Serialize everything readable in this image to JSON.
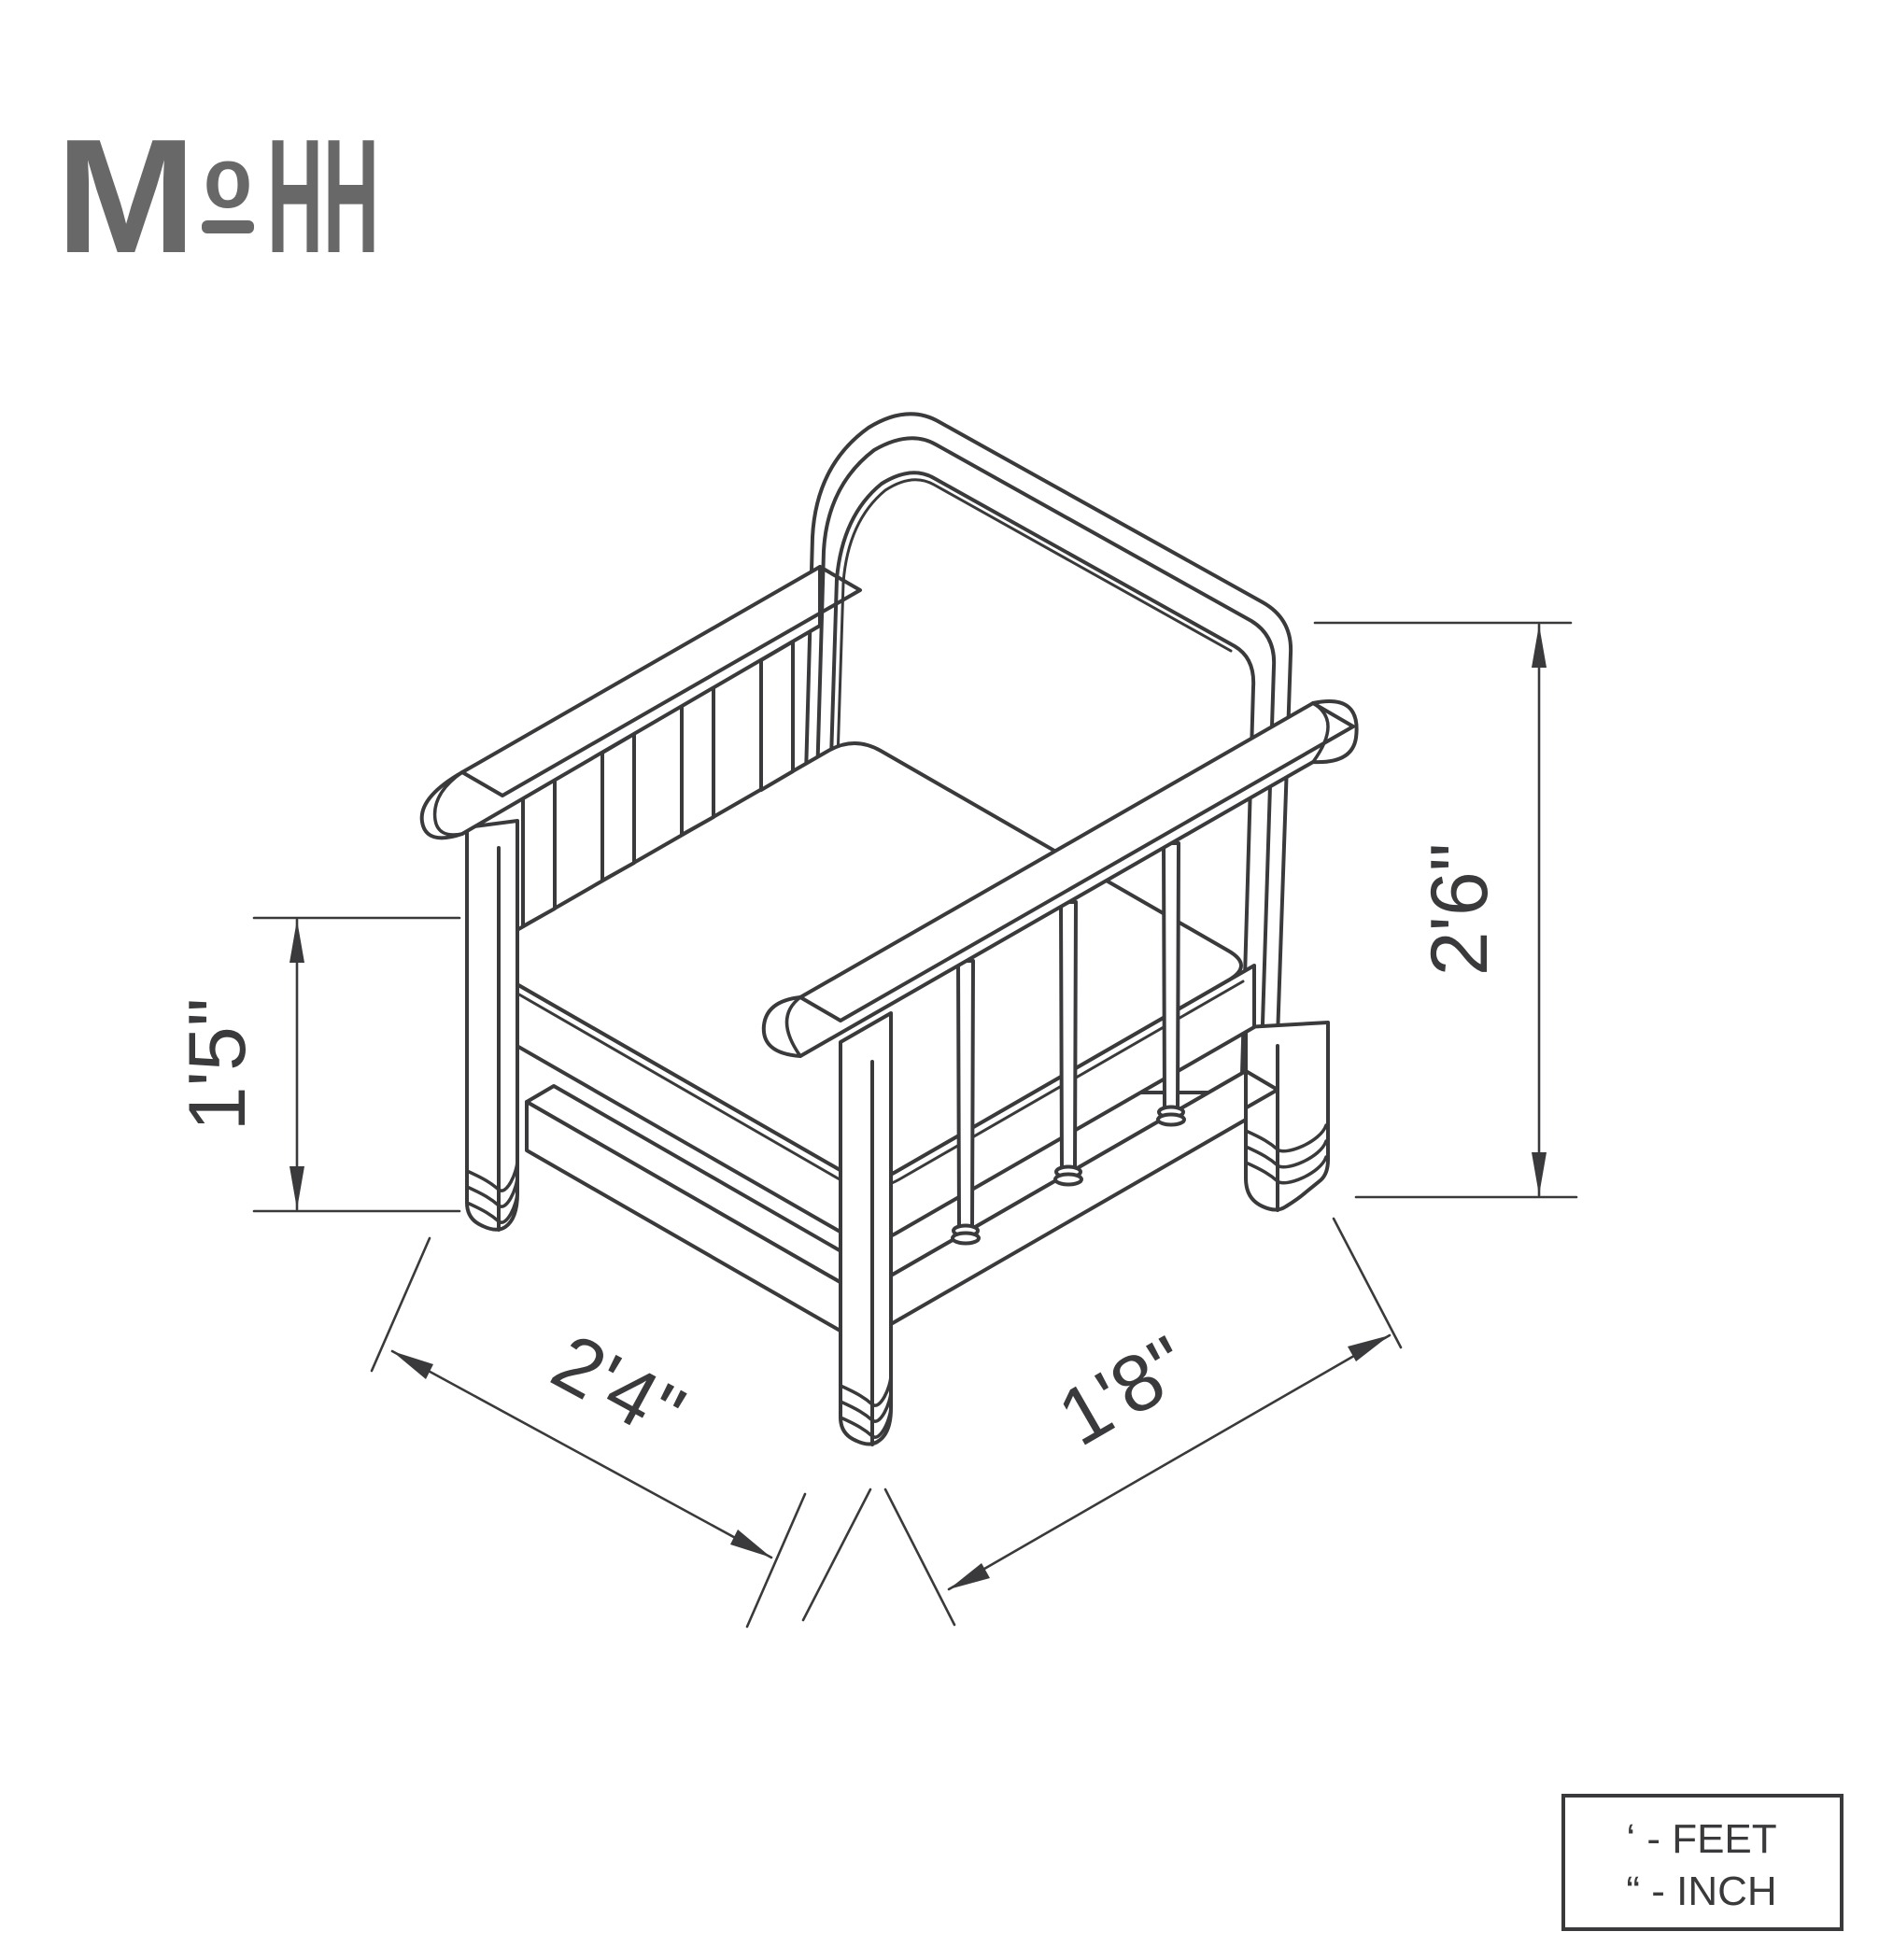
{
  "logo": {
    "part_m": "M",
    "part_o": "o",
    "part_hh": "HH",
    "full_name": "MoHH",
    "color": "#686868"
  },
  "drawing": {
    "subject": "armchair isometric dimension drawing",
    "line_color": "#3a3a3c",
    "background_color": "#ffffff"
  },
  "dimensions": {
    "seat_height_label": "1'5\"",
    "overall_height_label": "2'6\"",
    "overall_width_label": "2'4\"",
    "overall_depth_label": "1'8\""
  },
  "legend": {
    "feet_line": "‘ - FEET",
    "inch_line": "“ - INCH"
  }
}
